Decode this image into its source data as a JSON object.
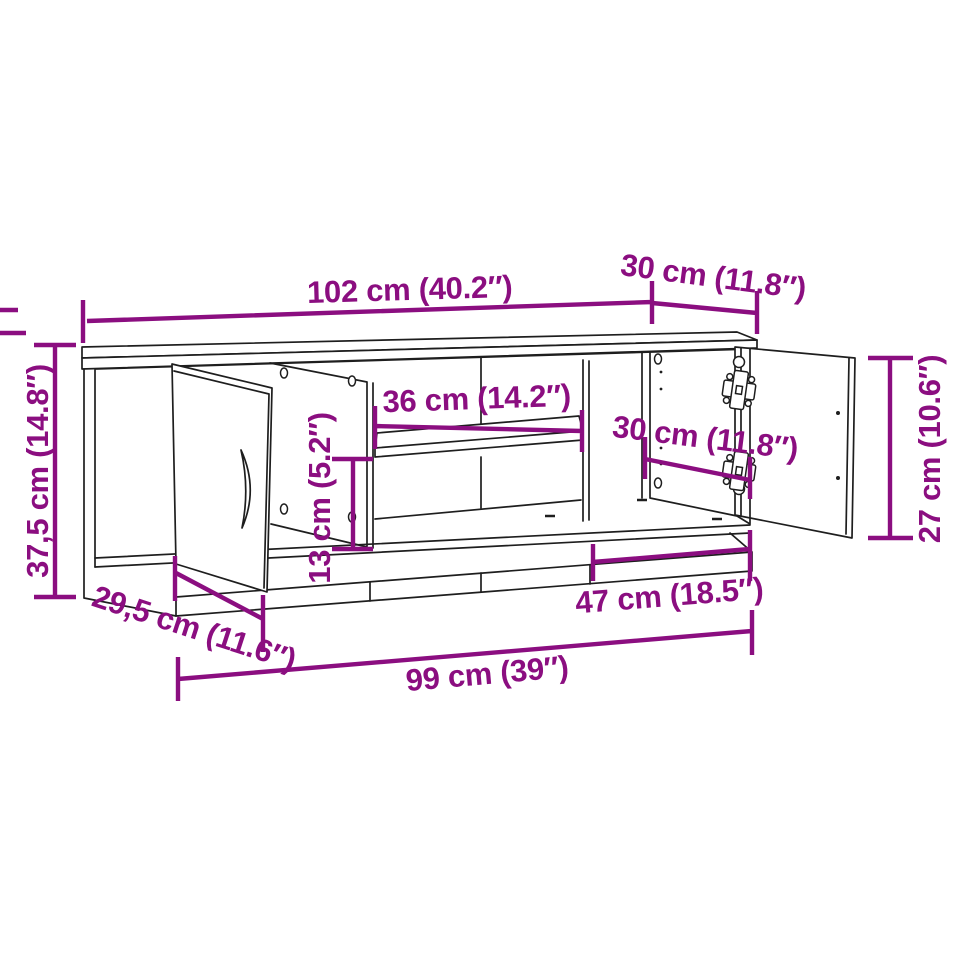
{
  "diagram": {
    "type": "furniture-dimension-drawing",
    "subject": "TV stand with two open doors, middle shelf and open compartments",
    "colors": {
      "dimension_accent": "#8B0E80",
      "drawing_line": "#1e1e1e",
      "background": "#ffffff"
    },
    "dimensions": {
      "top_width": "102 cm (40.2″)",
      "top_depth": "30 cm (11.8″)",
      "height": "37,5 cm (14.8″)",
      "shelf_width": "36 cm (14.2″)",
      "lower_opening_height": "13 cm (5.2″)",
      "right_compartment_width": "30 cm (11.8″)",
      "door_height": "27 cm (10.6″)",
      "base_depth": "29,5 cm (11.6″)",
      "base_right_section_width": "47 cm (18.5″)",
      "base_width": "99 cm (39″)"
    }
  }
}
